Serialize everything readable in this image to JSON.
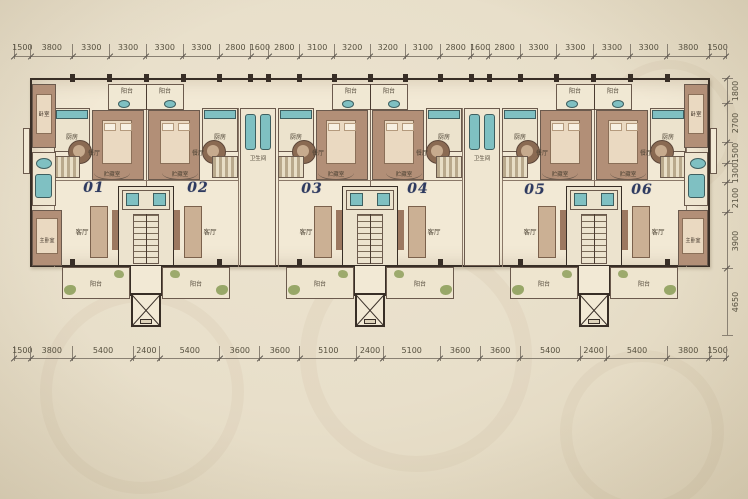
{
  "drawing": {
    "type": "residential-floor-plan",
    "units_count": 6
  },
  "dimensions": {
    "top": [
      "1500",
      "3800",
      "3300",
      "3300",
      "3300",
      "3300",
      "2800",
      "1600",
      "2800",
      "3100",
      "3200",
      "3200",
      "3100",
      "2800",
      "1600",
      "2800",
      "3300",
      "3300",
      "3300",
      "3300",
      "3800",
      "1500"
    ],
    "bottom": [
      "1500",
      "3800",
      "5400",
      "2400",
      "5400",
      "3600",
      "3600",
      "5100",
      "2400",
      "5100",
      "3600",
      "3600",
      "5400",
      "2400",
      "5400",
      "3800",
      "1500"
    ],
    "right": [
      "1800",
      "2700",
      "1500",
      "1300",
      "2100",
      "3900",
      "4650"
    ]
  },
  "sections": [
    {
      "left_unit": "01",
      "right_unit": "02"
    },
    {
      "left_unit": "03",
      "right_unit": "04"
    },
    {
      "left_unit": "05",
      "right_unit": "06"
    }
  ],
  "room_labels": {
    "balcony": "阳台",
    "kitchen": "厨房",
    "dining": "餐厅",
    "living": "客厅",
    "storage": "贮藏室",
    "bedroom": "卧室",
    "master_bedroom": "主卧室",
    "bathroom": "卫生间"
  },
  "colors": {
    "wall": "#382e26",
    "room_brown": "#b28f77",
    "bed": "#ead9c1",
    "teal": "#7fc0c2",
    "plant": "#8ea05c",
    "paper": "#f2e9d5",
    "unit_number": "#2e3a60",
    "dim_text": "#56503f"
  }
}
